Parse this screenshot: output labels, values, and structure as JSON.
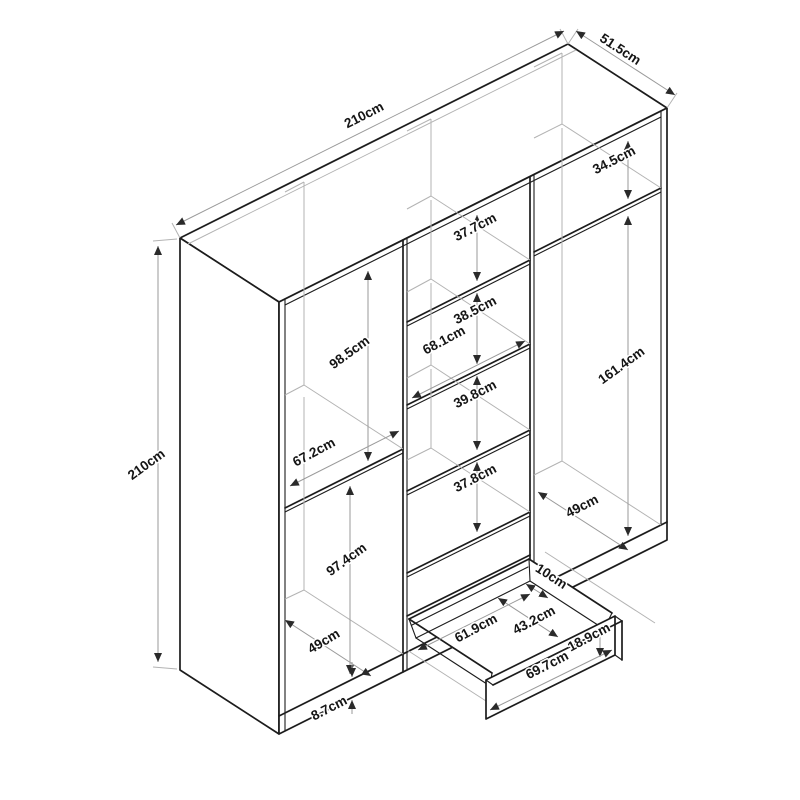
{
  "diagram": {
    "type": "furniture-dimension-drawing",
    "subject": "wardrobe with shelves and pull-out drawer",
    "units": "cm",
    "overall": {
      "width": "210cm",
      "depth": "51.5cm",
      "height": "210cm"
    },
    "left_section": {
      "upper_compartment_height": "98.5cm",
      "compartment_width": "67.2cm",
      "lower_compartment_height": "97.4cm",
      "compartment_depth": "49cm"
    },
    "middle_column": {
      "compartment_1_height": "37.7cm",
      "compartment_2_height": "38.5cm",
      "compartment_width": "68.1cm",
      "compartment_3_height": "39.8cm",
      "compartment_4_height": "37.8cm"
    },
    "right_section": {
      "top_compartment_height": "34.5cm",
      "hanging_space_height": "161.4cm",
      "compartment_depth": "49cm"
    },
    "drawer": {
      "rear_clearance": "10cm",
      "inner_width": "61.9cm",
      "inner_depth": "43.2cm",
      "front_height": "18.9cm",
      "front_width": "69.7cm"
    },
    "base": {
      "plinth_height": "8.7cm"
    },
    "colors": {
      "background": "#ffffff",
      "outline": "#1c1c1c",
      "dimension_line": "#9a9a9a",
      "interior_line": "#b3b3b3",
      "label_text": "#151515"
    }
  }
}
